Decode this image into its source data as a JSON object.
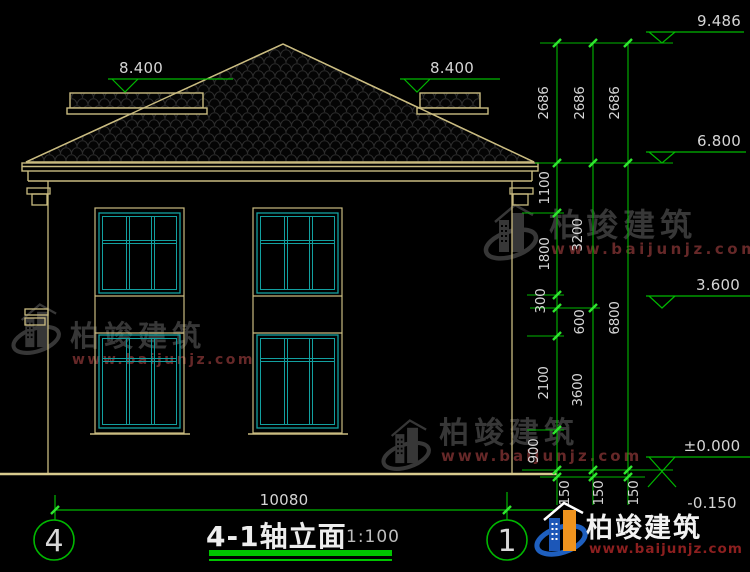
{
  "title_block": {
    "title": "4-1轴立面",
    "scale": "1:100"
  },
  "axes": {
    "left": "4",
    "right": "1"
  },
  "levels": {
    "ridge": "9.486",
    "wing_left": "8.400",
    "wing_right": "8.400",
    "eave": "6.800",
    "floor2": "3.600",
    "zero": "±0.000",
    "below": "-0.150"
  },
  "dims": {
    "total_width": "10080",
    "roof_chain": [
      "2686",
      "2686",
      "2686"
    ],
    "inner_chain": [
      "1100",
      "1800",
      "300",
      "600",
      "2100",
      "900"
    ],
    "middle_chain": [
      "3200",
      "3600"
    ],
    "outer_chain": [
      "6800"
    ],
    "base_chain": [
      "150",
      "150",
      "150"
    ]
  },
  "brand": {
    "name": "柏竣建筑",
    "url": "www.baijunjz.com"
  },
  "colors": {
    "line_green": "#00B800",
    "tick_green": "#2FE62F",
    "outline_tan": "#C9BB80",
    "window_cyan": "#12A0A0",
    "text_gray": "#D5D5D5",
    "watermark_gray": "#3C3C3C",
    "watermark_red": "#702C2C",
    "logo_blue": "#1E5FBF",
    "logo_orange": "#F0941E"
  }
}
